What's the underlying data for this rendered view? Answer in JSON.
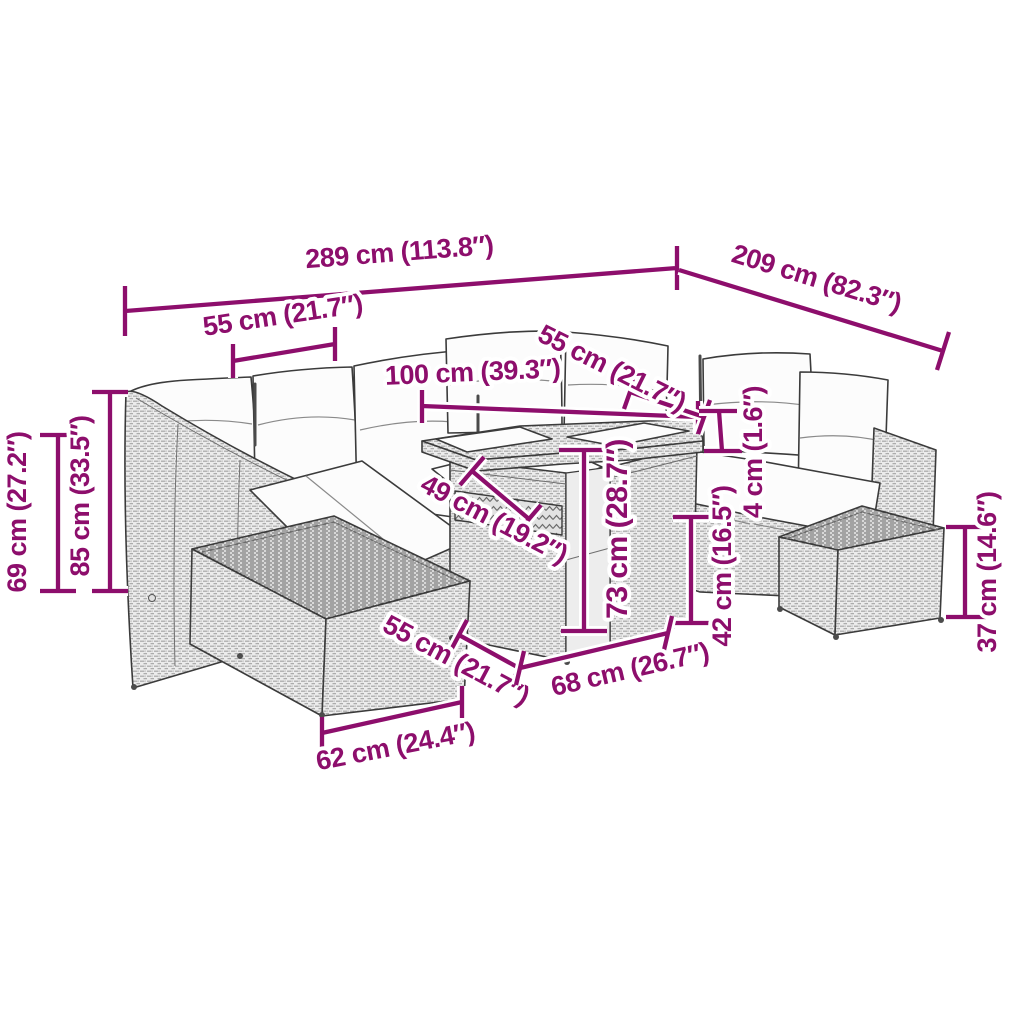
{
  "diagram": {
    "type": "product-dimension-diagram",
    "subject": "rattan garden lounge set with coffee table and footstool",
    "accent_color": "#8d0e6c",
    "outline_color": "#3b3b3b",
    "dimensions": {
      "total_width": {
        "label": "289 cm (113.8″)"
      },
      "total_depth": {
        "label": "209 cm (82.3″)"
      },
      "left_seat_width": {
        "label": "55 cm (21.7″)"
      },
      "table_length": {
        "label": "100 cm (39.3″)"
      },
      "right_seat_width": {
        "label": "55 cm (21.7″)"
      },
      "cushion_thickness": {
        "label": "4 cm (1.6″)"
      },
      "back_height": {
        "label": "69 cm (27.2″)"
      },
      "total_height": {
        "label": "85 cm (33.5″)"
      },
      "table_depth": {
        "label": "49 cm (19.2″)"
      },
      "table_height": {
        "label": "73 cm (28.7″)"
      },
      "seat_height": {
        "label": "42 cm (16.5″)"
      },
      "footstool_height": {
        "label": "37 cm (14.6″)"
      },
      "footstool_width": {
        "label": "55 cm (21.7″)"
      },
      "table_width": {
        "label": "68 cm (26.7″)"
      },
      "footstool_depth": {
        "label": "62 cm (24.4″)"
      }
    }
  }
}
